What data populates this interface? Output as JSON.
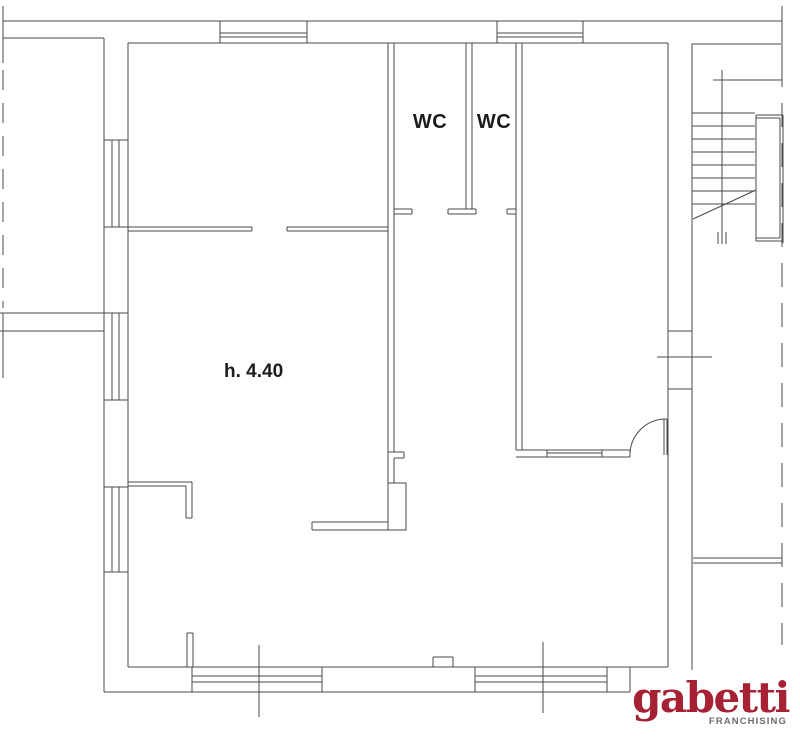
{
  "meta": {
    "width": 800,
    "height": 752,
    "background": "#ffffff",
    "line_color": "#4a4a4a",
    "text_color": "#1c1c1c"
  },
  "labels": {
    "wc_left": "WC",
    "wc_right": "WC",
    "height_note": "h. 4.40"
  },
  "logo": {
    "brand": "gabetti",
    "subbrand": "FRANCHISING",
    "brand_color": "#a72134",
    "subbrand_color": "#6f6a6d"
  }
}
